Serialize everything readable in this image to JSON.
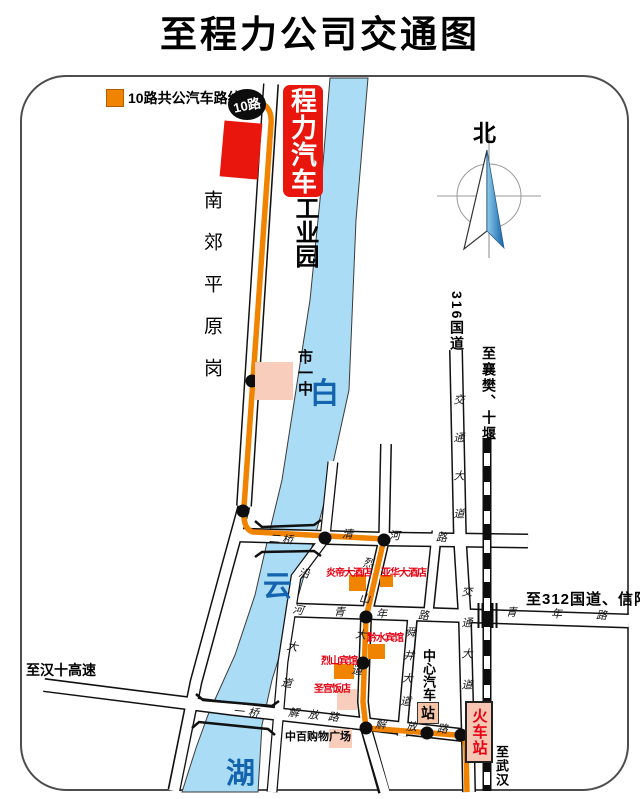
{
  "title": "至程力公司交通图",
  "legend": {
    "label": "10路共公汽车路线图",
    "badge": "10路"
  },
  "compass": {
    "north": "北"
  },
  "sign": {
    "top": "程力汽车",
    "bottom": "工业园"
  },
  "river": {
    "char1": "白",
    "char2": "云",
    "char3": "湖"
  },
  "area": {
    "nanjiao": "南郊平原岗"
  },
  "roads": {
    "erqiao": "二桥",
    "yiqiao": "一桥",
    "qinghe": "清河路",
    "qingnian": "青年路",
    "qingnian_east": "青年路",
    "jiefang_west": "解放路",
    "jiefang_east": "解放路",
    "lieshan_dadao": "烈山大道",
    "shunjing_dadao": "舜井大道",
    "jiaotong_upper": "交通大道",
    "jiaotong_lower": "交通大道",
    "yanhe_dadao": "沿河大道",
    "g316": "316国道"
  },
  "directions": {
    "xiangfan": "至襄樊、十堰",
    "g312": "至312国道、信阳",
    "hanshi": "至汉十高速",
    "wuhan": "至武汉"
  },
  "places": {
    "school": "市一中",
    "yandi_hotel": "炎帝大酒店",
    "yahua_hotel": "亚华大酒店",
    "qianshui_hotel": "黔水宾馆",
    "lieshan_hotel": "烈山宾馆",
    "shenggong_hotel": "圣宫饭店",
    "zhongbai_plaza": "中百购物广场",
    "bus_station": "中心汽车",
    "bus_station_badge": "站",
    "train_station": "火车站"
  },
  "colors": {
    "route_orange": "#F08300",
    "brand_red": "#E8160C",
    "river_blue": "#AADCF5",
    "river_text_blue": "#1463AE",
    "building_pink": "#F8CDBB",
    "station_pink": "#F7C6A9",
    "hotel_text_red": "#E60012"
  }
}
